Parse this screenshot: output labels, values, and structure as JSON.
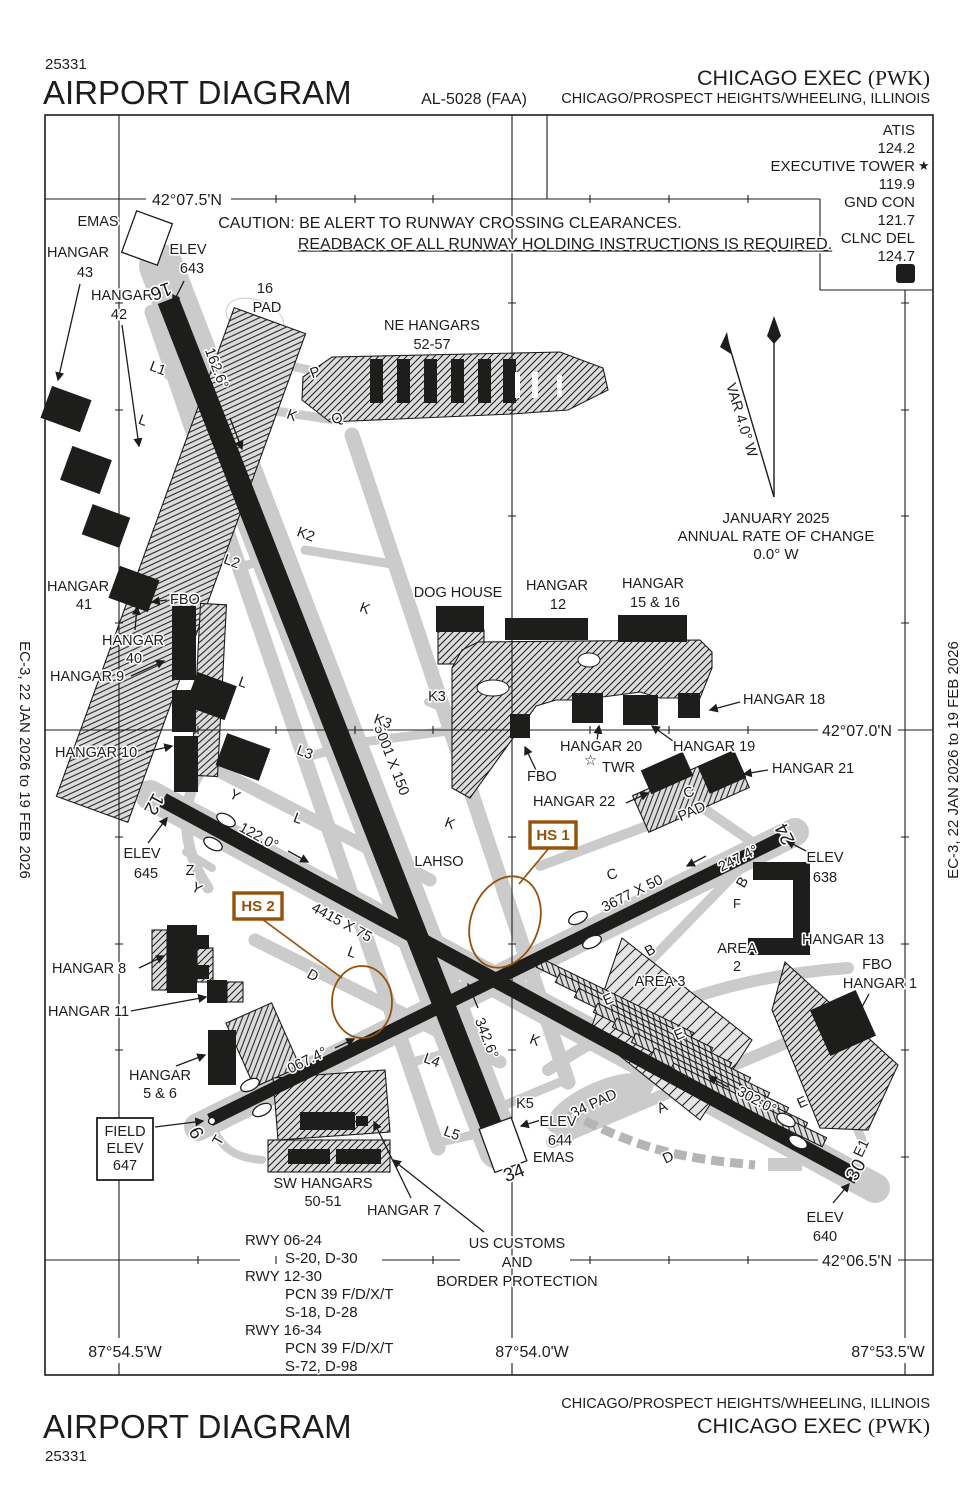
{
  "header": {
    "chart_number": "25331",
    "title": "AIRPORT DIAGRAM",
    "al_number": "AL-5028 (FAA)",
    "airport_name": "CHICAGO EXEC",
    "airport_id": "(PWK)",
    "city": "CHICAGO/PROSPECT HEIGHTS/WHEELING, ILLINOIS"
  },
  "footer": {
    "title": "AIRPORT DIAGRAM",
    "chart_number": "25331",
    "airport_name": "CHICAGO EXEC",
    "airport_id": "(PWK)",
    "city": "CHICAGO/PROSPECT HEIGHTS/WHEELING, ILLINOIS"
  },
  "margin_note": "EC-3, 22 JAN 2026 to 19 FEB 2026",
  "comms": {
    "atis_label": "ATIS",
    "atis_freq": "124.2",
    "tower_label": "EXECUTIVE TOWER",
    "tower_star": "★",
    "tower_freq": "119.9",
    "gnd_label": "GND CON",
    "gnd_freq": "121.7",
    "clnc_label": "CLNC DEL",
    "clnc_freq": "124.7",
    "datis_icon": "D"
  },
  "caution": {
    "line1": "CAUTION: BE ALERT TO RUNWAY CROSSING CLEARANCES.",
    "line2": "READBACK OF ALL RUNWAY HOLDING INSTRUCTIONS IS REQUIRED."
  },
  "compass": {
    "variation": "VAR 4.0° W",
    "date": "JANUARY 2025",
    "rate_label": "ANNUAL RATE OF CHANGE",
    "rate_value": "0.0° W"
  },
  "grid": {
    "lat_075": "42°07.5'N",
    "lat_070": "42°07.0'N",
    "lat_065": "42°06.5'N",
    "lon_545": "87°54.5'W",
    "lon_540": "87°54.0'W",
    "lon_535": "87°53.5'W"
  },
  "runways": {
    "rwy_16_34": {
      "dimensions": "5001 X 150",
      "heading_16": "162.6°",
      "heading_34": "342.6°",
      "thr_16": "16",
      "thr_34": "34"
    },
    "rwy_12_30": {
      "dimensions": "4415 X 75",
      "heading_12": "122.0°",
      "heading_30": "302.0°",
      "thr_12": "12",
      "thr_30": "30"
    },
    "rwy_06_24": {
      "dimensions": "3677 X 50",
      "heading_06": "067.4°",
      "heading_24": "247.4°",
      "thr_06": "6",
      "thr_24": "24"
    }
  },
  "elevations": {
    "elev_word": "ELEV",
    "field_l1": "FIELD",
    "field_l2": "ELEV",
    "field_l3": "647",
    "rwy16": "643",
    "rwy12": "645",
    "rwy24": "638",
    "rwy34": "644",
    "rwy30": "640"
  },
  "hotspots": {
    "hs1": "HS 1",
    "hs2": "HS 2",
    "lahso": "LAHSO"
  },
  "pads": {
    "pad16_l1": "16",
    "pad16_l2": "PAD",
    "pad34": "34 PAD",
    "cpad_l1": "C",
    "cpad_l2": "PAD"
  },
  "facilities": {
    "hangar_word": "HANGAR",
    "h43": "43",
    "h42": "42",
    "h41": "41",
    "h40": "40",
    "h12": "12",
    "h1516": "15 & 16",
    "h56": "5 & 6",
    "h9": "HANGAR 9",
    "h10": "HANGAR 10",
    "h18": "HANGAR 18",
    "h19": "HANGAR 19",
    "h20": "HANGAR 20",
    "h21": "HANGAR 21",
    "h22": "HANGAR 22",
    "h13": "HANGAR 13",
    "h8": "HANGAR 8",
    "h11": "HANGAR 11",
    "h7": "HANGAR 7",
    "h1": "HANGAR 1",
    "ne_hangars_l1": "NE HANGARS",
    "ne_hangars_l2": "52-57",
    "sw_hangars_l1": "SW HANGARS",
    "sw_hangars_l2": "50-51",
    "dog_house": "DOG HOUSE",
    "fbo": "FBO",
    "twr": "TWR",
    "twr_star": "☆",
    "area_word": "AREA",
    "area2_num": "2",
    "area3": "AREA 3",
    "emas": "EMAS",
    "customs_l1": "US CUSTOMS",
    "customs_l2": "AND",
    "customs_l3": "BORDER PROTECTION"
  },
  "taxiways": {
    "a": "A",
    "b": "B",
    "c": "C",
    "d": "D",
    "e": "E",
    "e1": "E1",
    "f": "F",
    "k": "K",
    "k2": "K2",
    "k3": "K3",
    "k5": "K5",
    "l": "L",
    "l1": "L1",
    "l2": "L2",
    "l3": "L3",
    "l4": "L4",
    "l5": "L5",
    "p": "P",
    "q": "Q",
    "t": "T",
    "y": "Y",
    "z": "Z"
  },
  "runway_data": [
    "RWY 06-24",
    "S-20, D-30",
    "RWY 12-30",
    "PCN 39 F/D/X/T",
    "S-18, D-28",
    "RWY 16-34",
    "PCN 39 F/D/X/T",
    "S-72, D-98"
  ],
  "colors": {
    "hotspot": "#96500a",
    "pavement": "#cbcbcb",
    "ink": "#1d1d1b"
  }
}
